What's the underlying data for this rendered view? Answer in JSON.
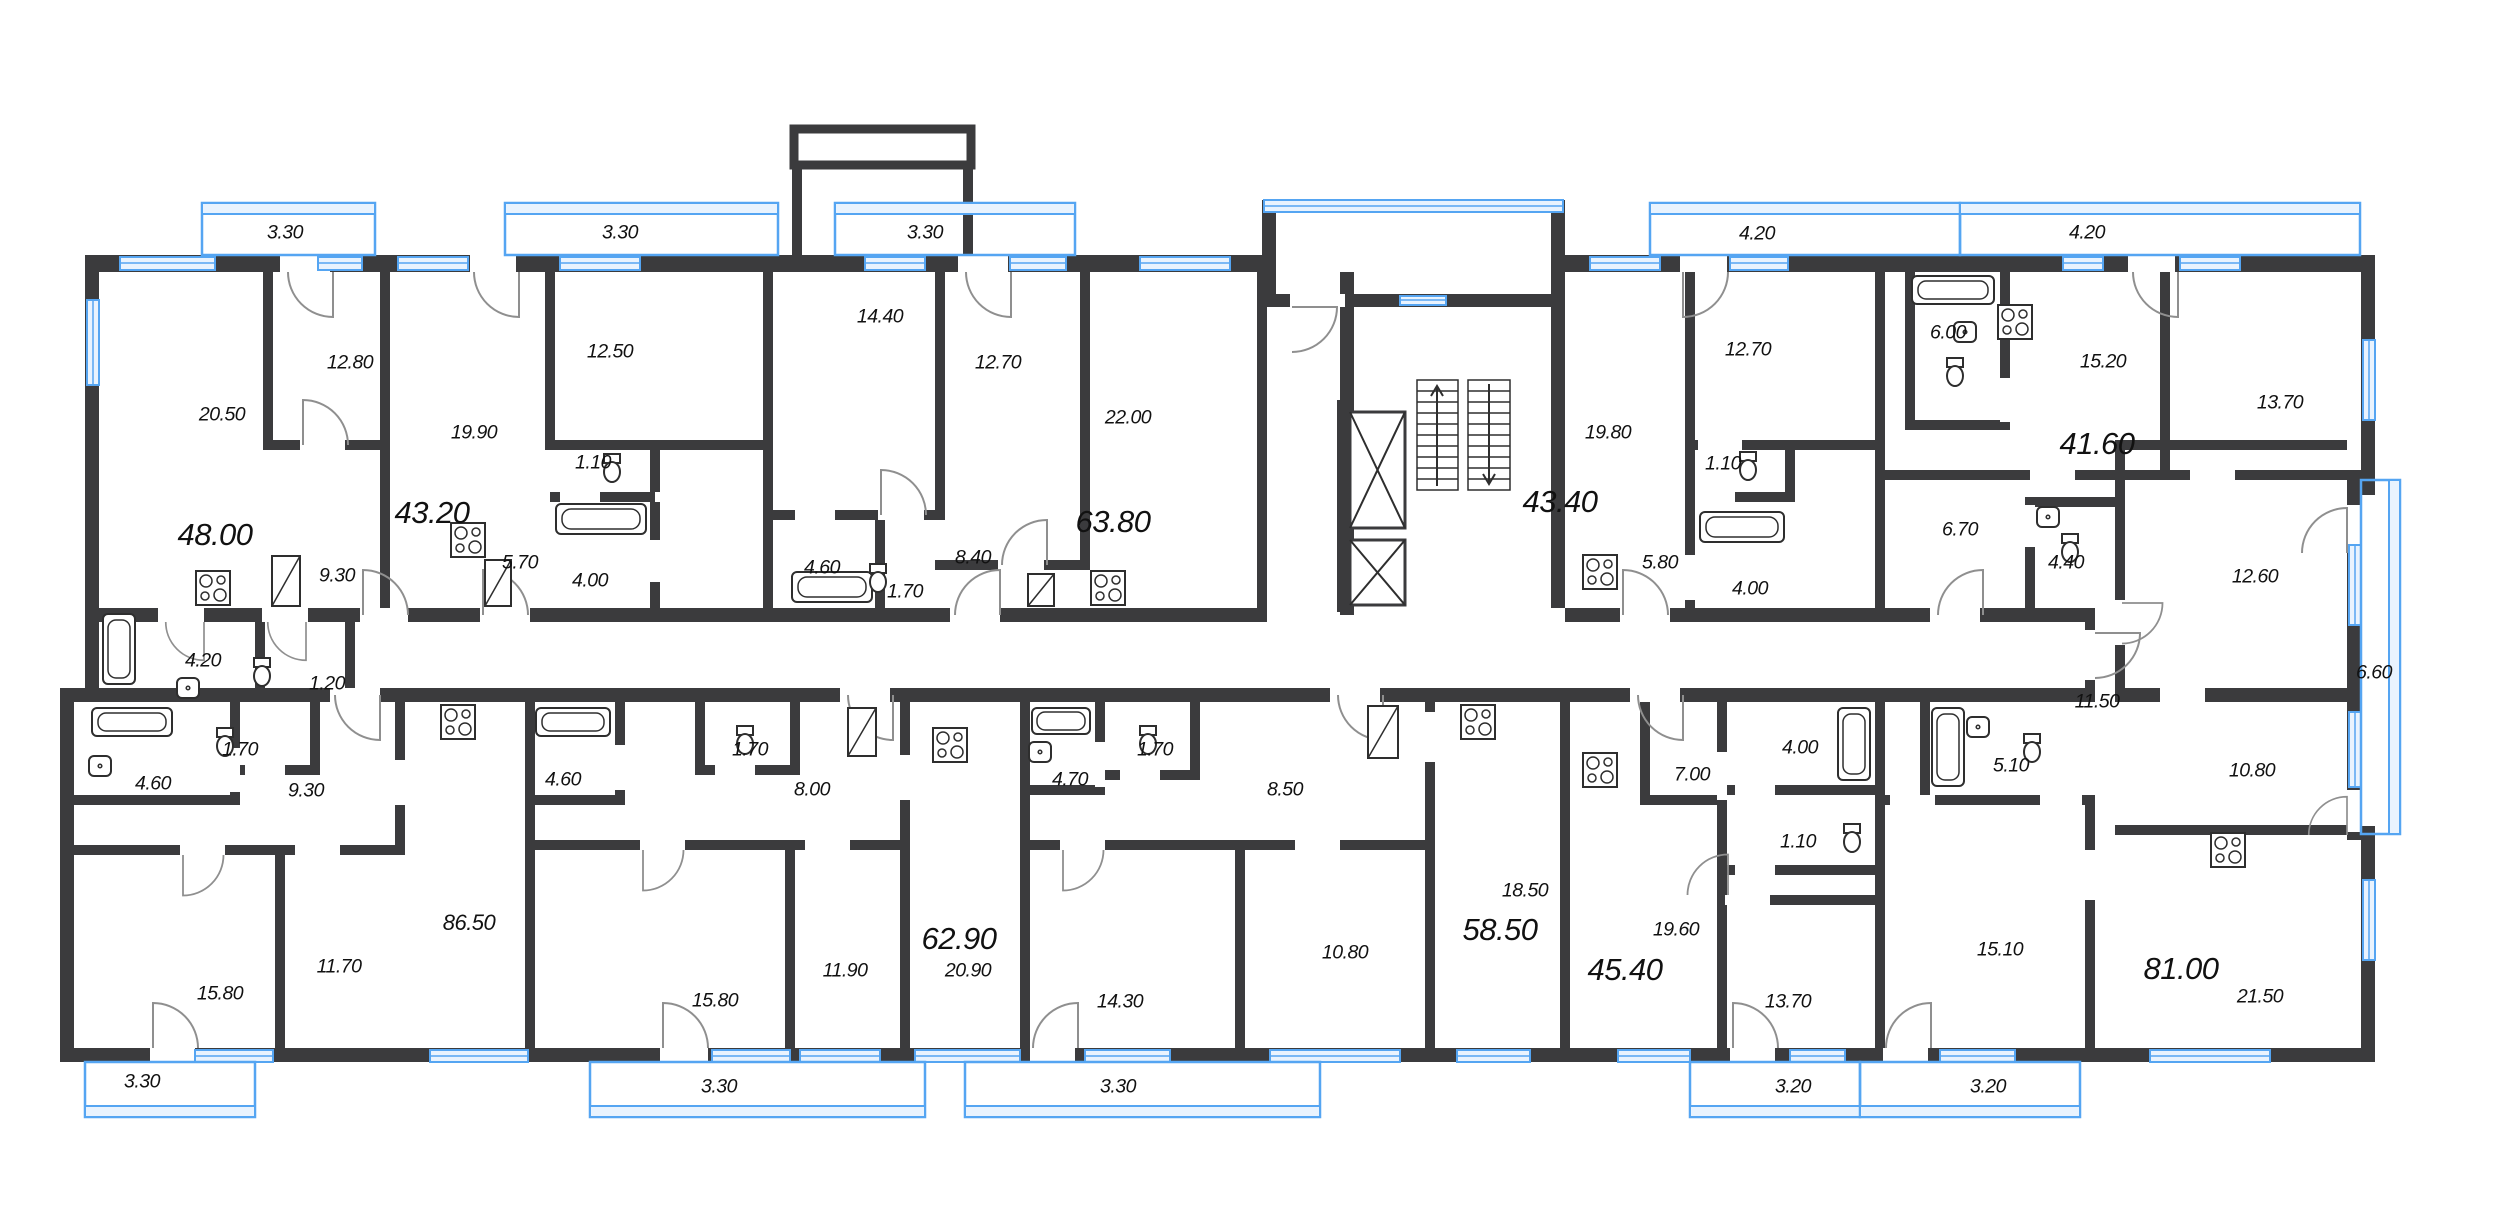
{
  "document": {
    "type": "residential-floor-plan",
    "colors": {
      "wall": "#3b3b3d",
      "glazing": "#55a5f2",
      "glazing_fill": "#e9f3fe",
      "text": "#111111",
      "door_arc": "#8f8f8f"
    },
    "icons": [
      "bathtub-icon",
      "toilet-icon",
      "sink-icon",
      "stove-icon",
      "elevator-icon",
      "stairs-icon",
      "wardrobe-icon",
      "window-glyph",
      "balcony-glazing"
    ]
  },
  "units": [
    {
      "total": "48.00",
      "rooms": [
        "20.50",
        "12.80",
        "9.30",
        "4.20",
        "1.20"
      ],
      "balconies": [
        "3.30"
      ]
    },
    {
      "total": "43.20",
      "rooms": [
        "19.90",
        "12.50",
        "5.70",
        "4.00",
        "1.10"
      ],
      "balconies": [
        "3.30"
      ]
    },
    {
      "total": "63.80",
      "rooms": [
        "22.00",
        "14.40",
        "12.70",
        "8.40",
        "4.60",
        "1.70"
      ],
      "balconies": [
        "3.30"
      ]
    },
    {
      "total": "43.40",
      "rooms": [
        "19.80",
        "12.70",
        "5.80",
        "4.00",
        "1.10"
      ],
      "balconies": [
        "4.20"
      ]
    },
    {
      "total": "41.60",
      "rooms": [
        "15.20",
        "13.70",
        "6.70",
        "6.00",
        "4.40"
      ],
      "balconies": [
        "4.20"
      ]
    },
    {
      "total": "86.50",
      "rooms": [
        "15.80",
        "11.70",
        "9.30",
        "4.60",
        "1.70"
      ],
      "balconies": [
        "3.30"
      ]
    },
    {
      "total": "62.90",
      "rooms": [
        "20.90",
        "15.80",
        "11.90",
        "8.00",
        "4.60",
        "1.70"
      ],
      "balconies": [
        "3.30"
      ]
    },
    {
      "total": "58.50",
      "rooms": [
        "18.50",
        "14.30",
        "10.80",
        "8.50",
        "4.70",
        "1.70"
      ],
      "balconies": [
        "3.30"
      ]
    },
    {
      "total": "45.40",
      "rooms": [
        "19.60",
        "13.70",
        "7.00",
        "4.00",
        "1.10"
      ],
      "balconies": [
        "3.20"
      ]
    },
    {
      "total": "81.00",
      "rooms": [
        "21.50",
        "15.10",
        "12.60",
        "11.50",
        "10.80",
        "5.10",
        "4.40",
        "6.70"
      ],
      "balconies": [
        "3.20",
        "6.60"
      ]
    }
  ],
  "labels": [
    {
      "t": "3.30",
      "x": 285,
      "y": 233,
      "c": "md"
    },
    {
      "t": "3.30",
      "x": 620,
      "y": 233,
      "c": "md"
    },
    {
      "t": "3.30",
      "x": 925,
      "y": 233,
      "c": "md"
    },
    {
      "t": "4.20",
      "x": 1757,
      "y": 234,
      "c": "md"
    },
    {
      "t": "4.20",
      "x": 2087,
      "y": 233,
      "c": "md"
    },
    {
      "t": "20.50",
      "x": 222,
      "y": 415,
      "c": "md"
    },
    {
      "t": "12.80",
      "x": 350,
      "y": 363,
      "c": "md"
    },
    {
      "t": "48.00",
      "x": 215,
      "y": 535,
      "c": "xl"
    },
    {
      "t": "9.30",
      "x": 337,
      "y": 576,
      "c": "md"
    },
    {
      "t": "4.20",
      "x": 203,
      "y": 661,
      "c": "md"
    },
    {
      "t": "1.20",
      "x": 327,
      "y": 684,
      "c": "md"
    },
    {
      "t": "12.50",
      "x": 610,
      "y": 352,
      "c": "md"
    },
    {
      "t": "19.90",
      "x": 474,
      "y": 433,
      "c": "md"
    },
    {
      "t": "43.20",
      "x": 432,
      "y": 513,
      "c": "xl"
    },
    {
      "t": "1.10",
      "x": 593,
      "y": 463,
      "c": "md"
    },
    {
      "t": "5.70",
      "x": 520,
      "y": 563,
      "c": "md"
    },
    {
      "t": "4.00",
      "x": 590,
      "y": 581,
      "c": "md"
    },
    {
      "t": "14.40",
      "x": 880,
      "y": 317,
      "c": "md"
    },
    {
      "t": "12.70",
      "x": 998,
      "y": 363,
      "c": "md"
    },
    {
      "t": "22.00",
      "x": 1128,
      "y": 418,
      "c": "md"
    },
    {
      "t": "63.80",
      "x": 1113,
      "y": 522,
      "c": "xl"
    },
    {
      "t": "8.40",
      "x": 973,
      "y": 558,
      "c": "md"
    },
    {
      "t": "4.60",
      "x": 822,
      "y": 568,
      "c": "md"
    },
    {
      "t": "1.70",
      "x": 905,
      "y": 592,
      "c": "md"
    },
    {
      "t": "12.70",
      "x": 1748,
      "y": 350,
      "c": "md"
    },
    {
      "t": "19.80",
      "x": 1608,
      "y": 433,
      "c": "md"
    },
    {
      "t": "43.40",
      "x": 1560,
      "y": 502,
      "c": "xl"
    },
    {
      "t": "1.10",
      "x": 1723,
      "y": 464,
      "c": "md"
    },
    {
      "t": "5.80",
      "x": 1660,
      "y": 563,
      "c": "md"
    },
    {
      "t": "4.00",
      "x": 1750,
      "y": 589,
      "c": "md"
    },
    {
      "t": "6.00",
      "x": 1948,
      "y": 333,
      "c": "md"
    },
    {
      "t": "15.20",
      "x": 2103,
      "y": 362,
      "c": "md"
    },
    {
      "t": "13.70",
      "x": 2280,
      "y": 403,
      "c": "md"
    },
    {
      "t": "41.60",
      "x": 2097,
      "y": 444,
      "c": "xl"
    },
    {
      "t": "6.70",
      "x": 1960,
      "y": 530,
      "c": "md"
    },
    {
      "t": "4.40",
      "x": 2066,
      "y": 563,
      "c": "md"
    },
    {
      "t": "12.60",
      "x": 2255,
      "y": 577,
      "c": "md"
    },
    {
      "t": "6.60",
      "x": 2374,
      "y": 673,
      "c": "md"
    },
    {
      "t": "4.60",
      "x": 153,
      "y": 784,
      "c": "md"
    },
    {
      "t": "1.70",
      "x": 240,
      "y": 750,
      "c": "md"
    },
    {
      "t": "9.30",
      "x": 306,
      "y": 791,
      "c": "md"
    },
    {
      "t": "15.80",
      "x": 220,
      "y": 994,
      "c": "md"
    },
    {
      "t": "11.70",
      "x": 339,
      "y": 967,
      "c": "md"
    },
    {
      "t": "86.50",
      "x": 469,
      "y": 923,
      "c": "lg"
    },
    {
      "t": "3.30",
      "x": 142,
      "y": 1082,
      "c": "md"
    },
    {
      "t": "4.60",
      "x": 563,
      "y": 780,
      "c": "md"
    },
    {
      "t": "1.70",
      "x": 750,
      "y": 750,
      "c": "md"
    },
    {
      "t": "8.00",
      "x": 812,
      "y": 790,
      "c": "md"
    },
    {
      "t": "15.80",
      "x": 715,
      "y": 1001,
      "c": "md"
    },
    {
      "t": "11.90",
      "x": 845,
      "y": 971,
      "c": "md"
    },
    {
      "t": "62.90",
      "x": 959,
      "y": 939,
      "c": "xl"
    },
    {
      "t": "20.90",
      "x": 968,
      "y": 971,
      "c": "md"
    },
    {
      "t": "3.30",
      "x": 719,
      "y": 1087,
      "c": "md"
    },
    {
      "t": "3.30",
      "x": 1118,
      "y": 1087,
      "c": "md"
    },
    {
      "t": "4.70",
      "x": 1070,
      "y": 780,
      "c": "md"
    },
    {
      "t": "1.70",
      "x": 1155,
      "y": 750,
      "c": "md"
    },
    {
      "t": "8.50",
      "x": 1285,
      "y": 790,
      "c": "md"
    },
    {
      "t": "10.80",
      "x": 1345,
      "y": 953,
      "c": "md"
    },
    {
      "t": "14.30",
      "x": 1120,
      "y": 1002,
      "c": "md"
    },
    {
      "t": "18.50",
      "x": 1525,
      "y": 891,
      "c": "md"
    },
    {
      "t": "58.50",
      "x": 1500,
      "y": 930,
      "c": "xl"
    },
    {
      "t": "19.60",
      "x": 1676,
      "y": 930,
      "c": "md"
    },
    {
      "t": "45.40",
      "x": 1625,
      "y": 970,
      "c": "xl"
    },
    {
      "t": "7.00",
      "x": 1692,
      "y": 775,
      "c": "md"
    },
    {
      "t": "4.00",
      "x": 1800,
      "y": 748,
      "c": "md"
    },
    {
      "t": "1.10",
      "x": 1798,
      "y": 842,
      "c": "md"
    },
    {
      "t": "13.70",
      "x": 1788,
      "y": 1002,
      "c": "md"
    },
    {
      "t": "3.20",
      "x": 1793,
      "y": 1087,
      "c": "md"
    },
    {
      "t": "3.20",
      "x": 1988,
      "y": 1087,
      "c": "md"
    },
    {
      "t": "11.50",
      "x": 2097,
      "y": 702,
      "c": "md"
    },
    {
      "t": "5.10",
      "x": 2011,
      "y": 766,
      "c": "md"
    },
    {
      "t": "15.10",
      "x": 2000,
      "y": 950,
      "c": "md"
    },
    {
      "t": "81.00",
      "x": 2181,
      "y": 969,
      "c": "xl"
    },
    {
      "t": "21.50",
      "x": 2260,
      "y": 997,
      "c": "md"
    },
    {
      "t": "10.80",
      "x": 2252,
      "y": 771,
      "c": "md"
    }
  ]
}
